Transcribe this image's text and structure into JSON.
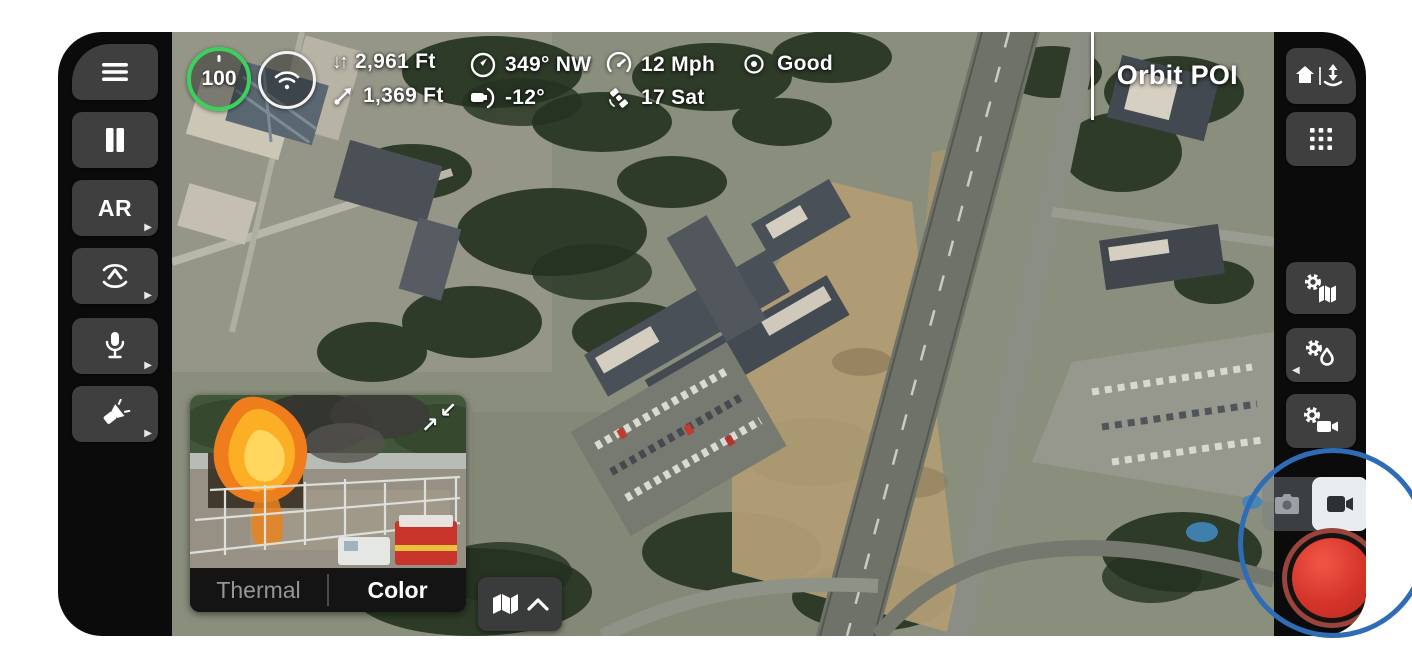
{
  "app": {
    "type": "drone-flight-controller",
    "frame_color": "#0b0b0c",
    "accent_green": "#3bd15c",
    "record_red": "#d5342a",
    "annotation_blue": "#2f6cb6"
  },
  "icons": {
    "alt_down": "↓",
    "alt_up": "↑",
    "submenu_right": "▶",
    "submenu_left": "◀",
    "swap_in": "↙",
    "swap_out": "↗"
  },
  "top_bar": {
    "battery": {
      "value": "100",
      "ring_color": "#3bd15c",
      "icon": "battery-ring"
    },
    "signal": {
      "icon": "wifi-icon"
    },
    "altitude": "2,961 Ft",
    "distance": "1,369 Ft",
    "heading": "349° NW",
    "gimbal_pitch": "-12°",
    "speed": "12 Mph",
    "satellites": "17 Sat",
    "visibility": "Good",
    "mode_label": "Orbit POI"
  },
  "left_toolbar": {
    "ar_label": "AR",
    "buttons": [
      "menu-icon",
      "pause-icon",
      "ar-button",
      "orbit-subject-icon",
      "microphone-icon",
      "spotlight-icon"
    ]
  },
  "right_toolbar": {
    "buttons": [
      "return-home-launch-icon",
      "grid-apps-icon",
      "map-settings-icon",
      "thermal-settings-icon",
      "video-settings-icon"
    ],
    "capture": {
      "photo_selected": false,
      "video_selected": true
    }
  },
  "pip": {
    "tabs": [
      {
        "label": "Thermal",
        "active": false
      },
      {
        "label": "Color",
        "active": true
      }
    ]
  }
}
